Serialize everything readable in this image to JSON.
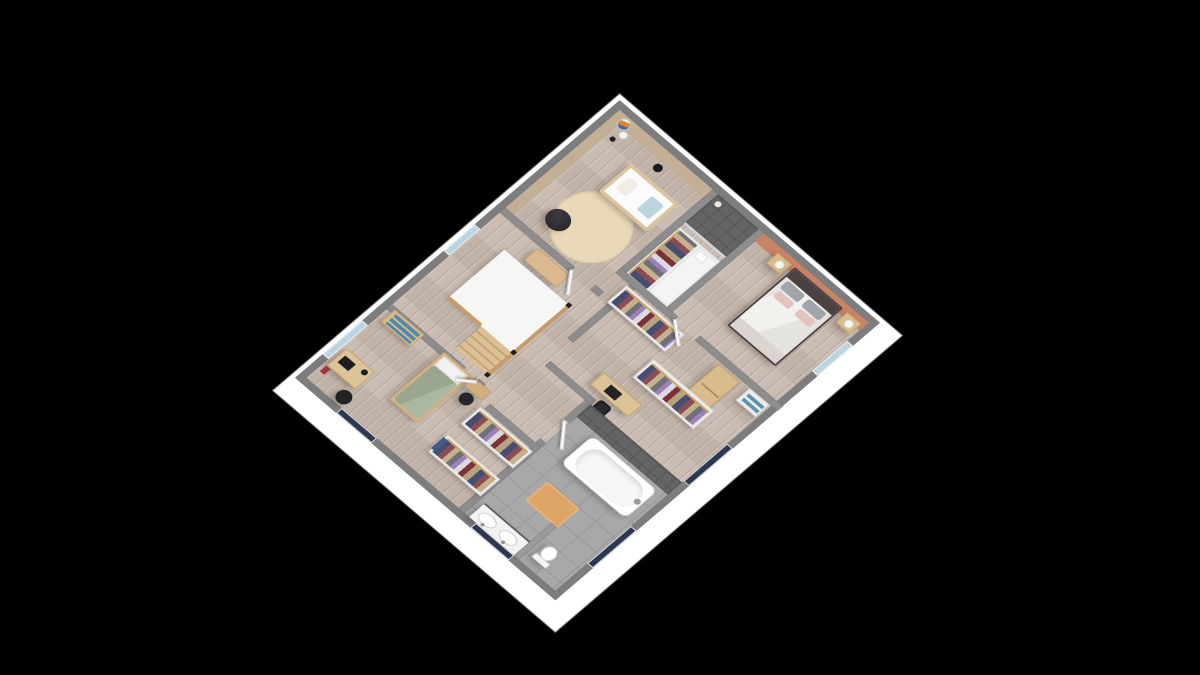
{
  "app": {
    "name": "3D floor plan viewer",
    "view": "Upper floor isometric 3D render",
    "background": "#000000"
  },
  "scene": {
    "rooms": [
      {
        "id": "nursery",
        "label": "Nursery",
        "furniture": [
          "baby crib",
          "round rug",
          "bean bag",
          "balloon floor lamp",
          "wardrobe with clothes"
        ]
      },
      {
        "id": "master-bedroom",
        "label": "Master bedroom",
        "furniture": [
          "double bed",
          "nightstand left",
          "nightstand right",
          "table lamps",
          "low window"
        ]
      },
      {
        "id": "shower-room",
        "label": "Walk-in shower",
        "furniture": [
          "tiled shower"
        ]
      },
      {
        "id": "dressing-office",
        "label": "Dressing and office area",
        "furniture": [
          "clothes rack",
          "clothes rack",
          "tall cabinet",
          "sideboard",
          "desk",
          "office chair"
        ]
      },
      {
        "id": "landing",
        "label": "Landing with staircase",
        "furniture": [
          "stairwell",
          "wood handrail",
          "stairs",
          "bench"
        ]
      },
      {
        "id": "kids-bedroom",
        "label": "Kids bedroom",
        "furniture": [
          "single bed green duvet",
          "head bench",
          "stool",
          "dresser with blue drawers",
          "desk with laptop",
          "desk chair"
        ]
      },
      {
        "id": "walk-in-closet",
        "label": "Walk-in closet",
        "furniture": [
          "clothes rack",
          "clothes rack"
        ]
      },
      {
        "id": "bathroom",
        "label": "Bathroom",
        "furniture": [
          "bathtub",
          "double sink vanity",
          "toilet",
          "bath mat",
          "tiled wall"
        ]
      }
    ],
    "colors": {
      "background": "#000000",
      "exterior_wall_top": "#7d7d7d",
      "interior_wall_top": "#8d8d8d",
      "wall_skirt": "#ffffff",
      "wood_floor": "#c7b8ad",
      "tile_floor": "#a8a8a8",
      "nursery_wall": "#c2af93",
      "accent_wall_terracotta": "#c97f60",
      "rug": "#ead9b8",
      "crib_wood": "#e6d6b6",
      "kids_duvet_green": "#9aa78e",
      "master_duvet": "#f3f1ed",
      "headboard_dark": "#4b4143",
      "pillow_gray": "#9fa5ab",
      "pillow_pink": "#e3c3bd",
      "shower_tile": "#646464",
      "stairwell_white": "#f6f6f5",
      "wood_furniture": "#d8bc8c",
      "bath_mat_orange": "#dfa566",
      "window_dark": "#2c3850",
      "window_light": "#bcd3e2",
      "balloon_orange": "#de8430",
      "balloon_blue": "#3f69b0",
      "clothes_palette": [
        "#454d72",
        "#8a4d55",
        "#c5b28a",
        "#6f6f7a",
        "#9d81b8",
        "#dadade",
        "#7d3038",
        "#b5a27e"
      ]
    }
  }
}
